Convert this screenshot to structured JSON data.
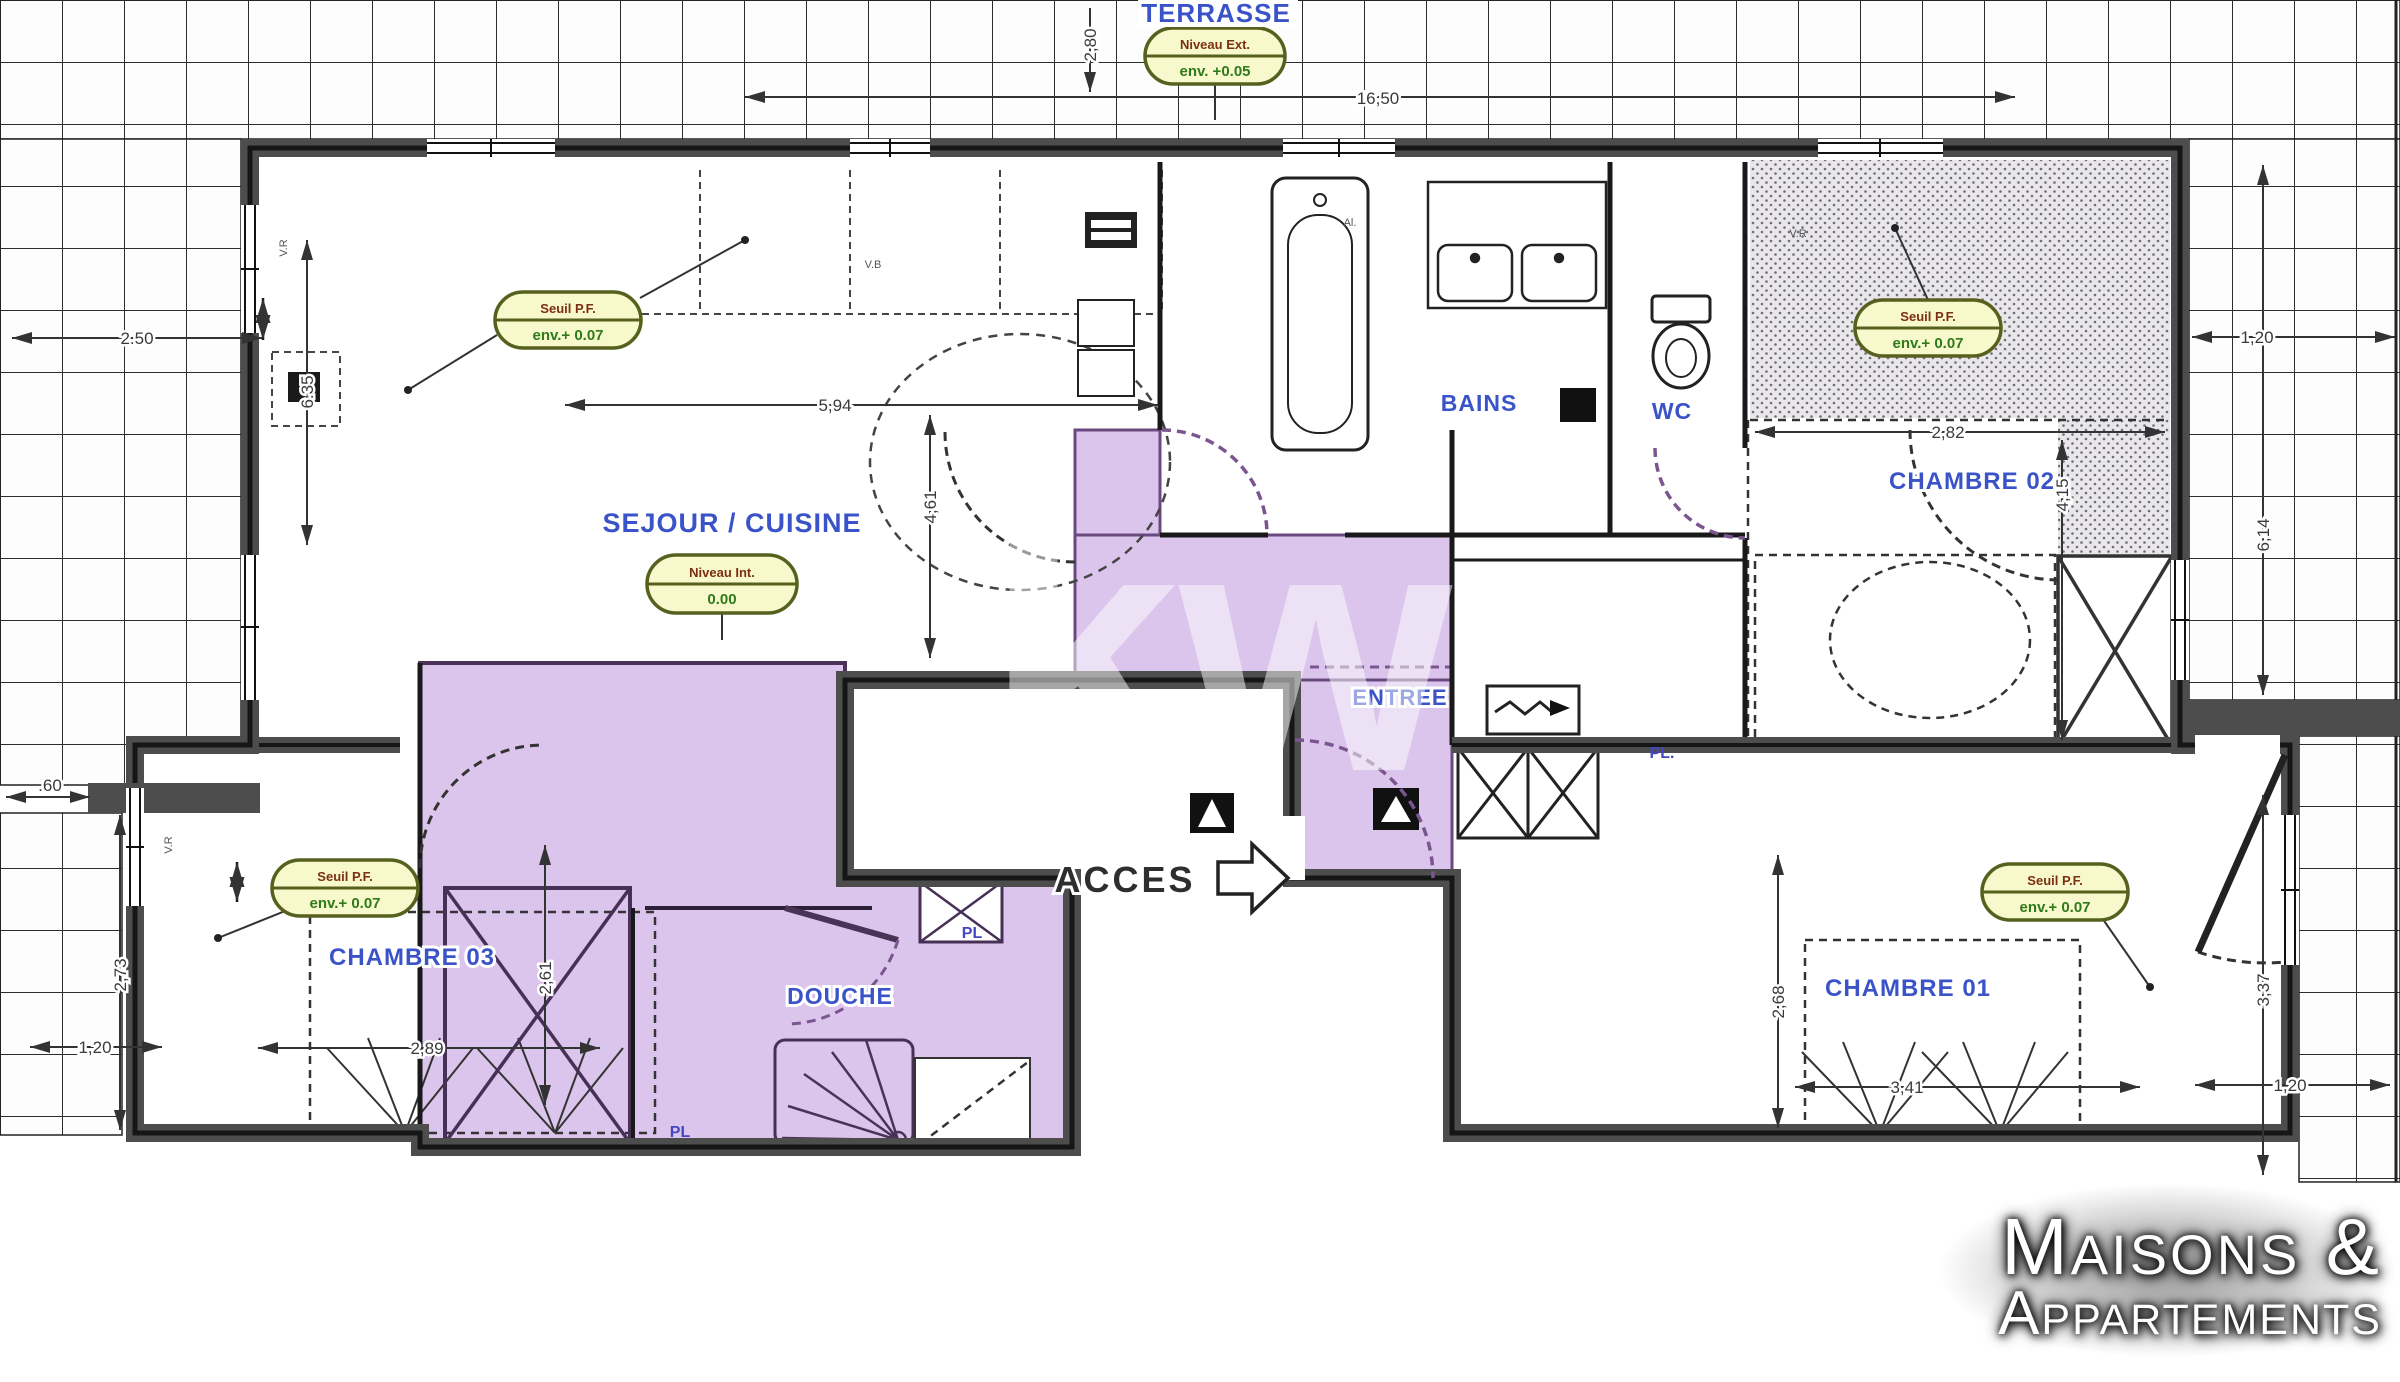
{
  "rooms": {
    "terrasse": "TERRASSE",
    "sejour_cuisine": "SEJOUR / CUISINE",
    "bains": "BAINS",
    "wc": "WC",
    "chambre02": "CHAMBRE 02",
    "chambre01": "CHAMBRE 01",
    "chambre03": "CHAMBRE 03",
    "douche": "DOUCHE",
    "entree": "ENTREE",
    "acces": "ACCES",
    "placard": "PL",
    "placard_dot": "PL."
  },
  "badges": {
    "niveau_ext": {
      "line1": "Niveau Ext.",
      "line2": "env. +0.05"
    },
    "niveau_int": {
      "line1": "Niveau Int.",
      "line2": "0.00"
    },
    "seuil_pf": {
      "line1": "Seuil P.F.",
      "line2": "env.+ 0.07"
    }
  },
  "dims": {
    "top_depth": "2,80",
    "top_width": "16,50",
    "left_width": "2.50",
    "left_height": "6.35",
    "sejour_width": "5,94",
    "sejour_height": "4,61",
    "chambre02_width": "2,82",
    "chambre02_height": "4,15",
    "right_top_width": "1,20",
    "right_top_height": "6,14",
    "left_stub": ".60",
    "chambre03_outer_height": "2,73",
    "chambre03_outer_width": "1,20",
    "chambre03_width": "2,89",
    "chambre03_height": "2,61",
    "chambre01_height": "2,68",
    "chambre01_width": "3,41",
    "right_bottom_height": "3,37",
    "right_bottom_width": "1,20"
  },
  "wall_labels": {
    "vr": "V.R",
    "vb": "V.B",
    "al": "Al."
  },
  "watermark": "kw",
  "logo": {
    "line1": "Maisons &",
    "line2": "Appartements"
  },
  "colors": {
    "room_label_blue": "#3a53c8",
    "zone_purple": "#dcc5ec",
    "badge_yellow": "#f8f8cd",
    "badge_text_brown": "#7c3012",
    "badge_text_green": "#2f7a1a",
    "wall_gray": "#4d4d4d"
  }
}
